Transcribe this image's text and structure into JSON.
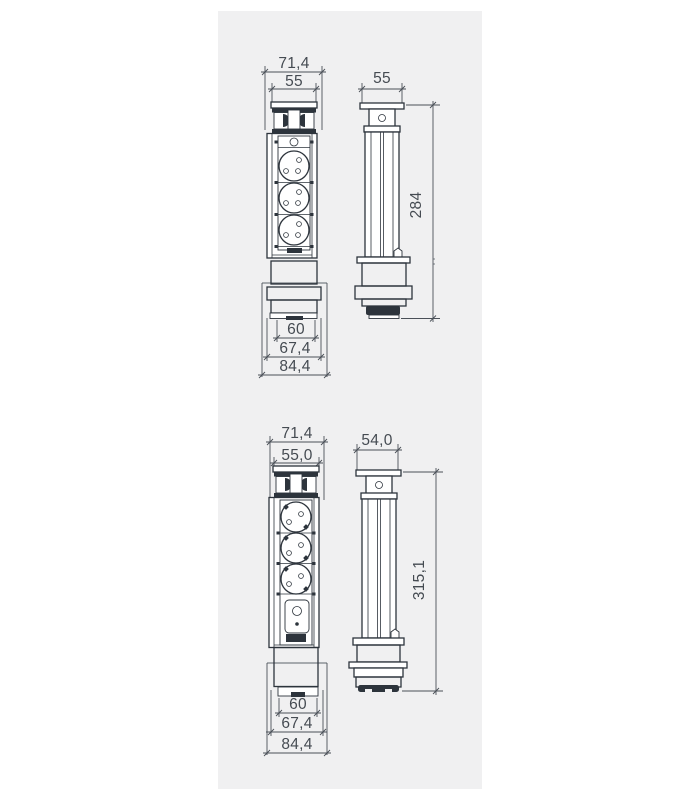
{
  "page": {
    "background": "#ffffff",
    "panel_background": "#f0f0f1",
    "line_color": "#2d343c",
    "dim_color": "#4a5058"
  },
  "variant1": {
    "front": {
      "outer_width": "71,4",
      "cap_width": "55",
      "base_width_inner": "60",
      "base_width_mid": "67,4",
      "base_width_outer": "84,4"
    },
    "side": {
      "cap_width": "55",
      "height": "284"
    }
  },
  "variant2": {
    "front": {
      "outer_width": "71,4",
      "cap_width": "55,0",
      "base_width_inner": "60",
      "base_width_mid": "67,4",
      "base_width_outer": "84,4"
    },
    "side": {
      "cap_width": "54,0",
      "height": "315,1"
    }
  }
}
